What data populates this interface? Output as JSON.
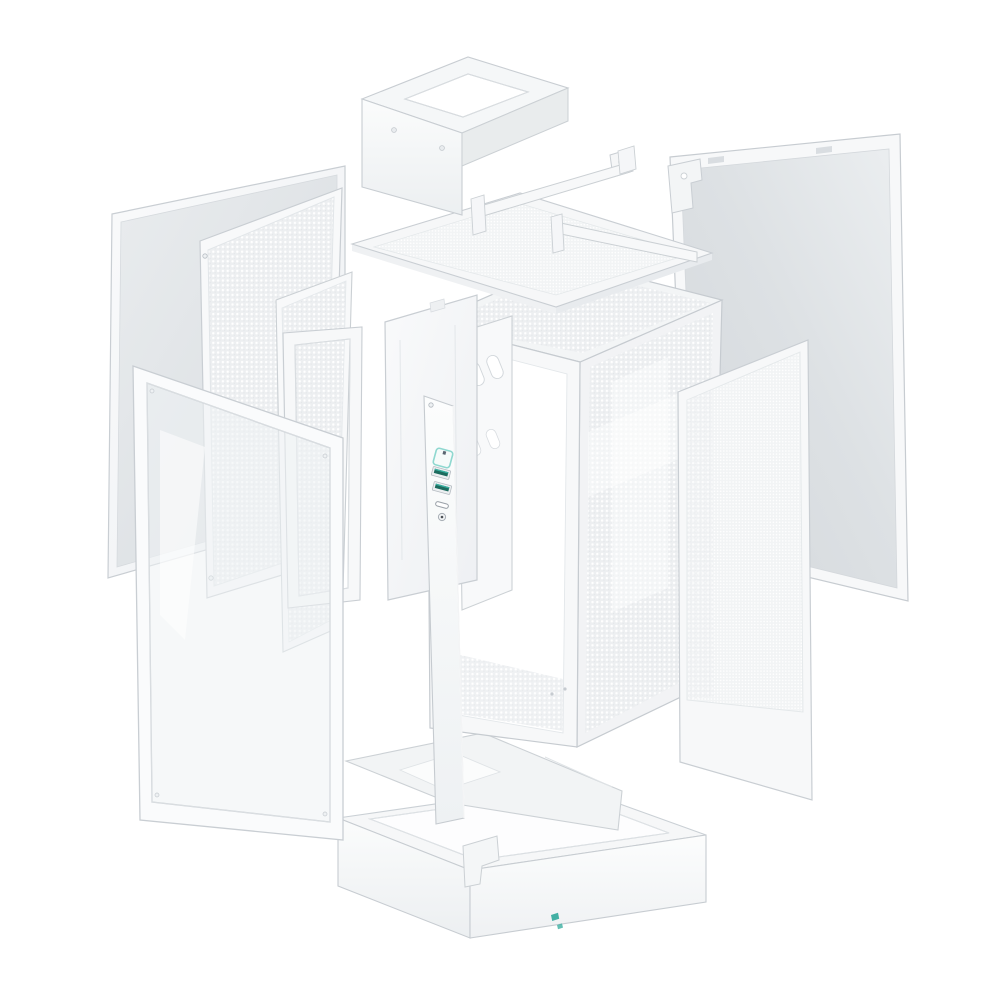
{
  "image": {
    "description": "Exploded view product render of a white mini-ITX PC tower case: detached side panels, mesh filters, brackets, glass front panel, chassis frame, bottom plate and base",
    "background": "#ffffff"
  },
  "palette": {
    "panel_white": "#f7f8f9",
    "panel_face_gray": "#e2e5e9",
    "edge_gray": "#c9ced3",
    "mesh_gray": "#edeff1",
    "accent_teal": "#35b2a5",
    "accent_teal_light": "#8fd8d0",
    "usb_port_teal": "#1d6b5e",
    "logo_teal": "#2fa99b"
  },
  "parts": [
    {
      "id": "solid-side-panel",
      "label": "solid side panel"
    },
    {
      "id": "side-mesh-panel",
      "label": "perforated side mesh panel"
    },
    {
      "id": "inner-mesh-bracket",
      "label": "inner mesh bracket panel"
    },
    {
      "id": "front-bracket-frame",
      "label": "front bracket frame"
    },
    {
      "id": "glass-front-panel",
      "label": "framed glass front panel"
    },
    {
      "id": "psu-bracket",
      "label": "PSU mounting bracket"
    },
    {
      "id": "top-dust-filter",
      "label": "top dust filter panel"
    },
    {
      "id": "support-rails",
      "label": "top support rails"
    },
    {
      "id": "main-chassis",
      "label": "main chassis frame"
    },
    {
      "id": "motherboard-tray",
      "label": "motherboard tray plate"
    },
    {
      "id": "right-side-panel",
      "label": "right solid side panel"
    },
    {
      "id": "right-mesh-filter",
      "label": "right mesh filter panel"
    },
    {
      "id": "front-io-panel",
      "label": "front I/O strip"
    },
    {
      "id": "bottom-plate",
      "label": "bottom plate"
    },
    {
      "id": "base-frame",
      "label": "base stand frame"
    },
    {
      "id": "small-bracket",
      "label": "small mounting bracket"
    }
  ],
  "front_io": {
    "controls": [
      "power-button",
      "usb-a-port",
      "usb-a-port",
      "usb-c-port",
      "audio-jack"
    ]
  },
  "brand": {
    "logo": "deepcool-logo-mark",
    "color": "#2fa99b"
  }
}
